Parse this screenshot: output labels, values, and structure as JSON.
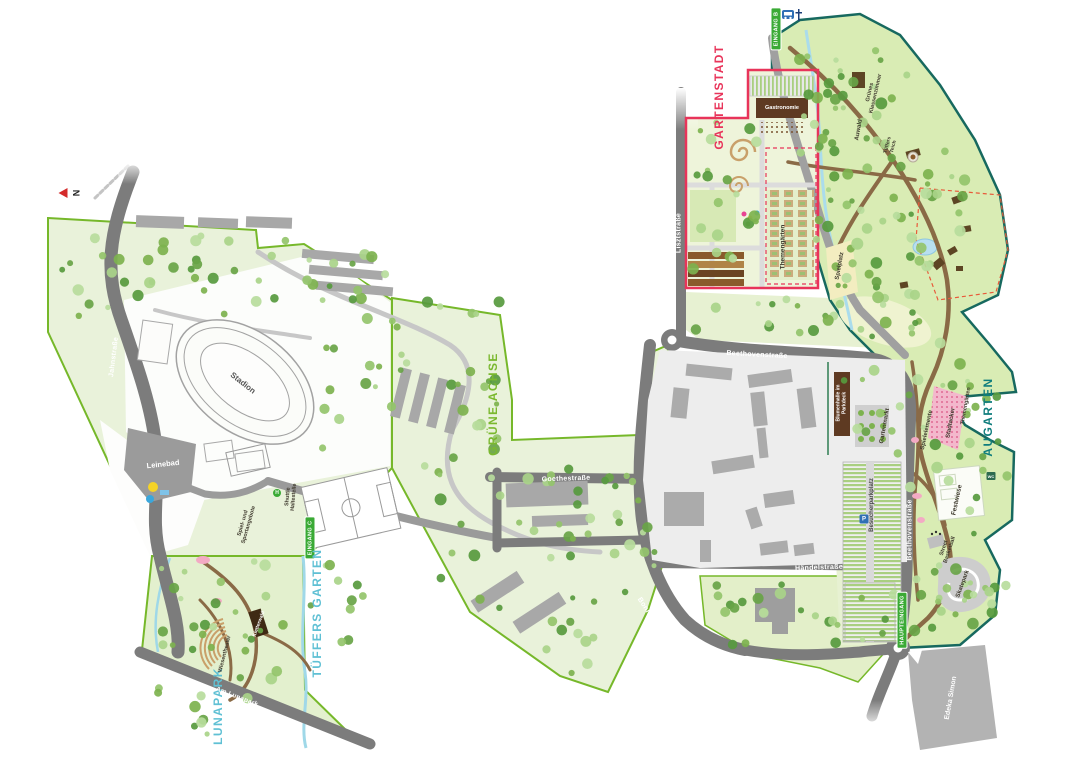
{
  "compass": {
    "north_label": "N"
  },
  "districts": {
    "gartenstadt": "GARTENSTADT",
    "augarten": "AUGARTEN",
    "gruene_achse": "GRÜNE ACHSE",
    "tueffers_garten": "TÜFFERS GARTEN",
    "lunapark": "LUNAPARK"
  },
  "streets": {
    "jahnstrasse": "Jahnstraße",
    "lisztstrasse": "Lisztstraße",
    "beethovenstrasse_nord": "Beethovenstraße",
    "beethovenstrasse_ost": "Beethovenstraße",
    "goethestrasse": "Goethestraße",
    "haendelstrasse": "Händelstraße",
    "bonifatiusplatz": "Bonifatiusplatz",
    "am_lunapark": "Am Lunapark"
  },
  "entrances": {
    "eingang_b": "EINGANG B",
    "eingang_c": "EINGANG C",
    "haupteingang": "HAUPTEINGANG"
  },
  "places": {
    "stadion": "Stadion",
    "leinebad": "Leinebad",
    "gastronomie": "Gastronomie",
    "themengaerten": "Themengärten",
    "spielplatz": "Spielplatz",
    "gruenes_klassenzimmer": "Grünes Klassenzimmer",
    "auwald": "Auwald",
    "tueffers_teich": "Tüffers Teich",
    "blumenhalle": "Blumenhalle im Parkdeck",
    "gartenmarkt": "Gartenmarkt",
    "besucherparkplatz": "Besucherparkplatz",
    "spielelemente": "Spielelemente",
    "stadtacker": "Stadtacker",
    "themengaerten_augarten": "Themengärten",
    "festwiese": "Festwiese",
    "street_basketball": "Street Basketball",
    "skatepark": "Skatepark",
    "edeka": "Edeka Simon",
    "shuttle_haltestelle": "Shuttle Haltestelle",
    "spiel_und_sport": "Spiel- und Sportangebote",
    "wiesentheater": "Wiesentheater",
    "kletterwald": "Kletterwald"
  },
  "icons": {
    "shuttle_stop": "H",
    "parking": "P",
    "wc": "WC"
  },
  "colors": {
    "gartenstadt_red": "#e8345a",
    "augarten_teal": "#0f7d7d",
    "gruene_achse_green": "#7ab82e",
    "water_cyan": "#5fc0d4",
    "entrance_green": "#3aaa35",
    "road_gray": "#7c7c7c",
    "park_green": "#e9f2da"
  }
}
